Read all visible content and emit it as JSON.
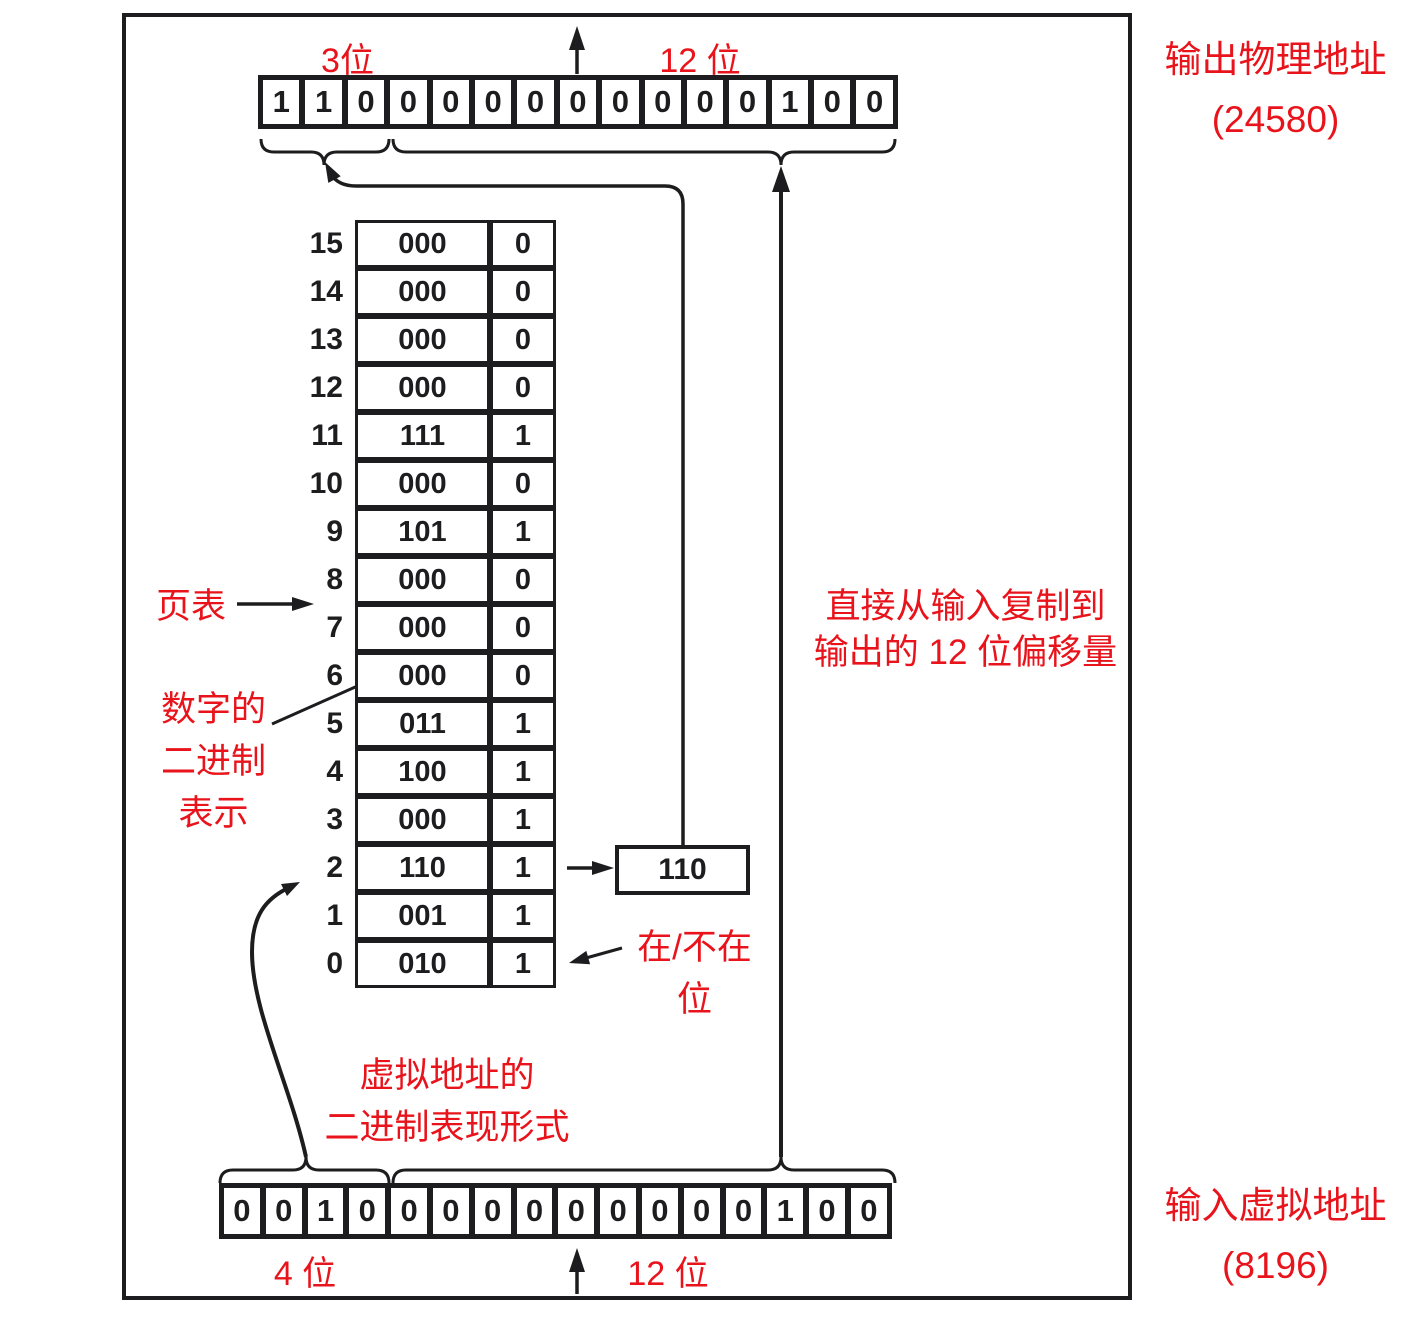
{
  "colors": {
    "red": "#e8131b",
    "ink": "#1d1d1f"
  },
  "output_address": {
    "title_line1": "输出物理地址",
    "title_line2": "(24580)",
    "high_bits_label": "3位",
    "low_bits_label": "12 位",
    "bits": [
      "1",
      "1",
      "0",
      "0",
      "0",
      "0",
      "0",
      "0",
      "0",
      "0",
      "0",
      "0",
      "1",
      "0",
      "0"
    ]
  },
  "input_address": {
    "title_line1": "输入虚拟地址",
    "title_line2": "(8196)",
    "high_bits_label": "4 位",
    "low_bits_label": "12 位",
    "bits": [
      "0",
      "0",
      "1",
      "0",
      "0",
      "0",
      "0",
      "0",
      "0",
      "0",
      "0",
      "0",
      "0",
      "1",
      "0",
      "0"
    ]
  },
  "page_table": {
    "label": "页表",
    "rows": [
      {
        "index": "15",
        "frame": "000",
        "present": "0"
      },
      {
        "index": "14",
        "frame": "000",
        "present": "0"
      },
      {
        "index": "13",
        "frame": "000",
        "present": "0"
      },
      {
        "index": "12",
        "frame": "000",
        "present": "0"
      },
      {
        "index": "11",
        "frame": "111",
        "present": "1"
      },
      {
        "index": "10",
        "frame": "000",
        "present": "0"
      },
      {
        "index": "9",
        "frame": "101",
        "present": "1"
      },
      {
        "index": "8",
        "frame": "000",
        "present": "0"
      },
      {
        "index": "7",
        "frame": "000",
        "present": "0"
      },
      {
        "index": "6",
        "frame": "000",
        "present": "0"
      },
      {
        "index": "5",
        "frame": "011",
        "present": "1"
      },
      {
        "index": "4",
        "frame": "100",
        "present": "1"
      },
      {
        "index": "3",
        "frame": "000",
        "present": "1"
      },
      {
        "index": "2",
        "frame": "110",
        "present": "1"
      },
      {
        "index": "1",
        "frame": "001",
        "present": "1"
      },
      {
        "index": "0",
        "frame": "010",
        "present": "1"
      }
    ]
  },
  "frame_box": {
    "value": "110"
  },
  "annotations": {
    "binary_of_number": [
      "数字的",
      "二进制",
      "表示"
    ],
    "present_absent": [
      "在/不在",
      "位"
    ],
    "offset_copy": [
      "直接从输入复制到",
      "输出的 12 位偏移量"
    ],
    "virtual_binary": [
      "虚拟地址的",
      "二进制表现形式"
    ]
  }
}
